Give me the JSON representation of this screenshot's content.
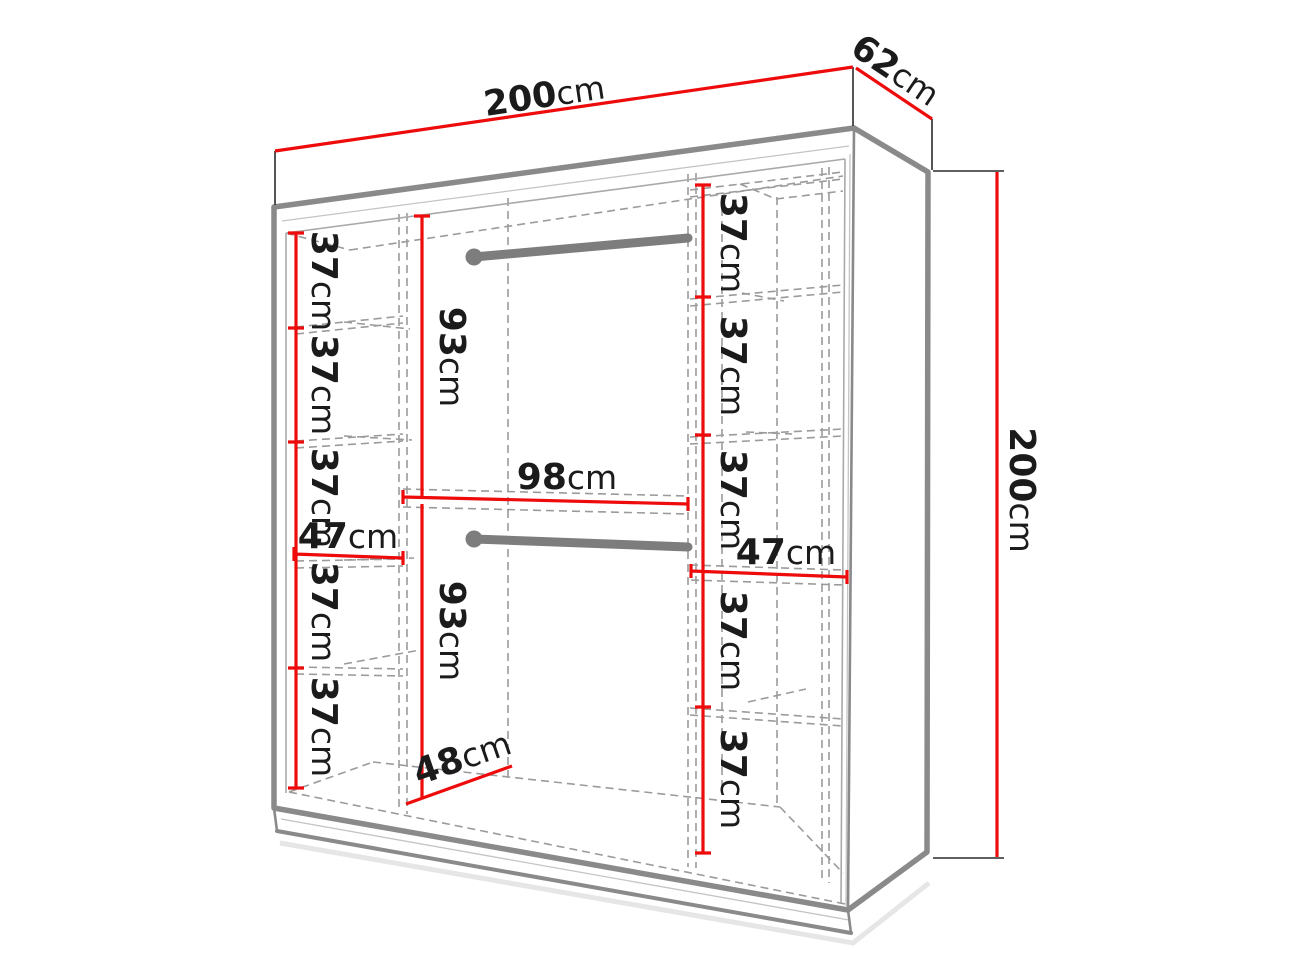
{
  "diagram": {
    "kind": "wardrobe-dimension-diagram",
    "unit": "cm",
    "overall": {
      "width": {
        "value": "200",
        "unit": "cm"
      },
      "depth": {
        "value": "62",
        "unit": "cm"
      },
      "height": {
        "value": "200",
        "unit": "cm"
      }
    },
    "left_column": {
      "shelves": [
        {
          "value": "37",
          "unit": "cm"
        },
        {
          "value": "37",
          "unit": "cm"
        },
        {
          "value": "37",
          "unit": "cm"
        },
        {
          "value": "37",
          "unit": "cm"
        },
        {
          "value": "37",
          "unit": "cm"
        }
      ],
      "width": {
        "value": "47",
        "unit": "cm"
      }
    },
    "right_column": {
      "shelves": [
        {
          "value": "37",
          "unit": "cm"
        },
        {
          "value": "37",
          "unit": "cm"
        },
        {
          "value": "37",
          "unit": "cm"
        },
        {
          "value": "37",
          "unit": "cm"
        },
        {
          "value": "37",
          "unit": "cm"
        }
      ],
      "width": {
        "value": "47",
        "unit": "cm"
      }
    },
    "center_section": {
      "upper_height": {
        "value": "93",
        "unit": "cm"
      },
      "lower_height": {
        "value": "93",
        "unit": "cm"
      },
      "width": {
        "value": "98",
        "unit": "cm"
      },
      "floor_depth": {
        "value": "48",
        "unit": "cm"
      }
    },
    "colors": {
      "dimension_line": "#ee0b0b",
      "edge": "#8a8a8a",
      "dashed": "#9b9b9b",
      "rod": "#7d7d7d",
      "text": "#1b1b1b",
      "background": "#ffffff"
    }
  }
}
